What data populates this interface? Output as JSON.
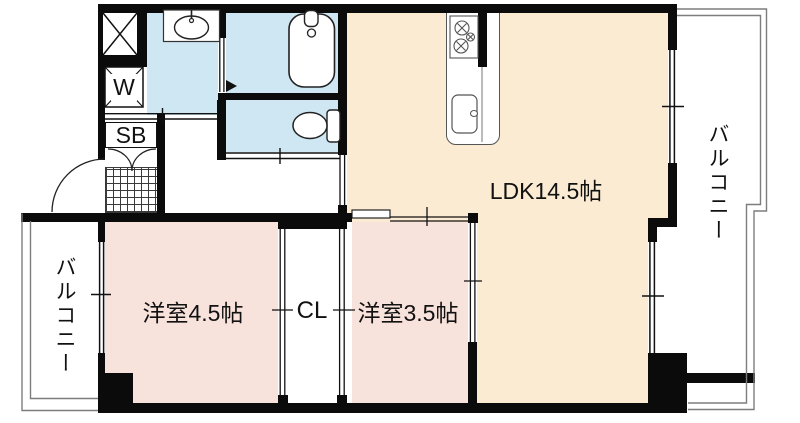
{
  "plan": {
    "type": "floor-plan",
    "rooms": {
      "ldk": {
        "label": "LDK14.5帖"
      },
      "western_room_1": {
        "label": "洋室4.5帖"
      },
      "western_room_2": {
        "label": "洋室3.5帖"
      },
      "closet": {
        "label": "CL"
      },
      "shoe_box": {
        "label": "SB"
      },
      "washer_space": {
        "label": "W"
      },
      "balcony_left": {
        "label": "バルコニー"
      },
      "balcony_right": {
        "label": "バルコニー"
      }
    },
    "fixtures": {
      "bathtub": "bathtub",
      "toilet": "toilet",
      "washbasin": "washbasin",
      "kitchen_stove": "stove-2-burner",
      "kitchen_sink": "kitchen-sink",
      "entrance_door": "door-swing-arc",
      "shoe_box_doors": "double-door-arcs",
      "pipe_shaft": "x-box",
      "entrance_step": "hatched-genkan"
    },
    "colors": {
      "ldk_fill": "#faebd2",
      "western_room_fill": "#f8e2dc",
      "wet_area_fill": "#cfe6f3",
      "wall": "#0b0b0b",
      "balcony_line": "#7d7d7d",
      "fixture_line": "#333333"
    }
  }
}
